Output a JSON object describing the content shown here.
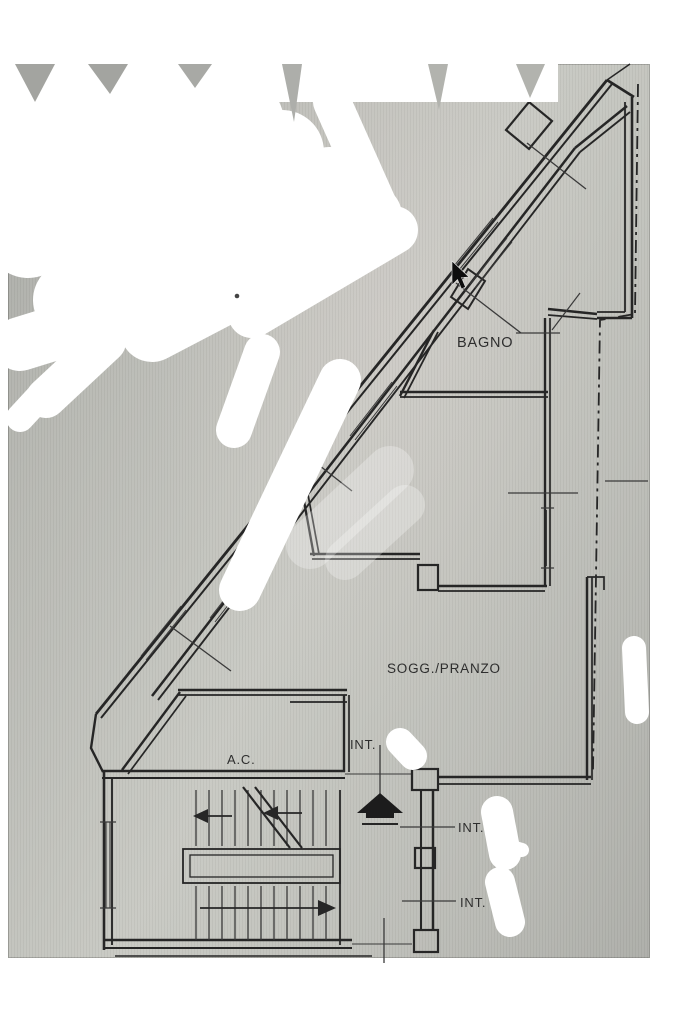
{
  "photo": {
    "background": "#b9bab4",
    "line_color": "#262626",
    "label_color": "#2e2e2e",
    "redaction_color": "#ffffff"
  },
  "plan": {
    "room_labels": [
      {
        "id": "bagno",
        "text": "BAGNO"
      },
      {
        "id": "sogg-pranzo",
        "text": "SOGG./PRANZO"
      },
      {
        "id": "ac",
        "text": "A.C."
      }
    ],
    "door_labels": [
      {
        "id": "int-1",
        "text": "INT."
      },
      {
        "id": "int-2",
        "text": "INT."
      },
      {
        "id": "int-3",
        "text": "INT."
      }
    ]
  },
  "cursor": {
    "type": "arrow-pointer"
  }
}
